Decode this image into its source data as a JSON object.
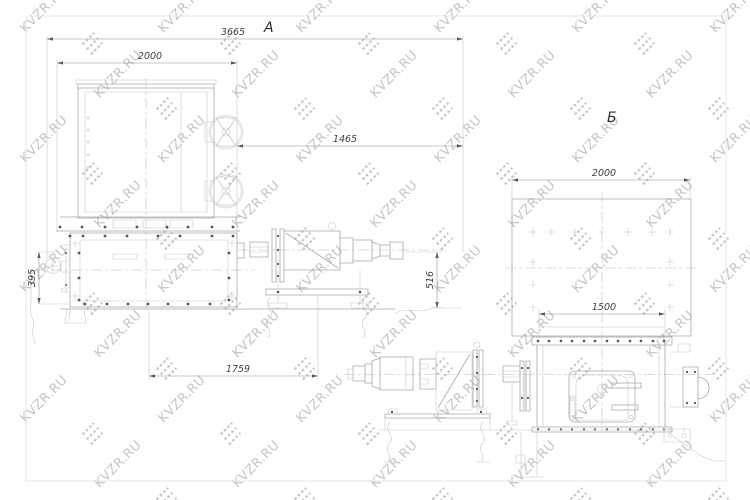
{
  "watermark": {
    "text": "KVZR.RU",
    "text_color": "#c5c5c9",
    "logo_color": "#c8c8cc",
    "logo_icon": "kvzr-stripes-logo"
  },
  "frame": {
    "border_color": "#e4e4e7"
  },
  "drawing": {
    "type": "technical engineering drawing, two views of a mixer machine with drive unit",
    "line_color": "#a7a7ad",
    "light_line_color": "#c8c8cd",
    "bolt_color": "#54545a",
    "dimension_text_color": "#3e3e44",
    "views": {
      "a": {
        "label": "А",
        "dims": {
          "d3665": "3665",
          "d2000": "2000",
          "d1465": "1465",
          "d516": "516",
          "d395": "395",
          "d1759": "1759"
        }
      },
      "b": {
        "label": "Б",
        "dims": {
          "d2000": "2000",
          "d1500": "1500"
        }
      }
    }
  }
}
